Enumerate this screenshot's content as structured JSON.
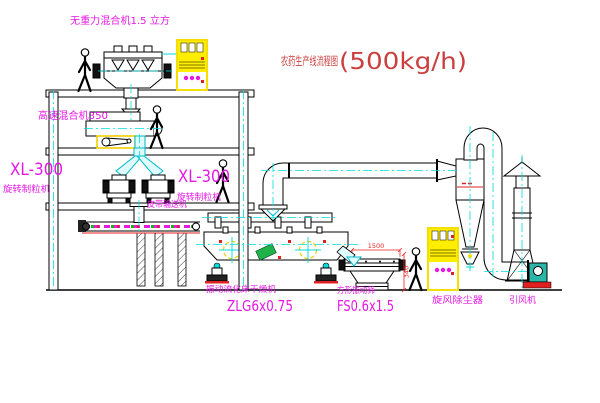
{
  "title": {
    "text_cn": "农药生产线流程图",
    "capacity": "(500kg/h)"
  },
  "labels": {
    "gravity_mixer": "无重力混合机1.5 立方",
    "high_speed_mixer": "高速混合机350",
    "granulator_left_model": "XL-300",
    "granulator_left_name": "旋转制粒机",
    "granulator_right_model": "XL-300",
    "granulator_right_name": "旋转制粒机",
    "belt_conveyor": "皮带输送机",
    "fluid_bed_dryer_name": "振动流化床干燥机",
    "fluid_bed_dryer_model": "ZLG6x0.75",
    "square_sieve_name": "方形振动筛",
    "square_sieve_model": "FS0.6x1.5",
    "cyclone": "旋风除尘器",
    "induced_draft_fan": "引风机"
  },
  "dimensions": {
    "sieve_length": "1500",
    "sieve_height": "340"
  },
  "colors": {
    "label": "#e518e5",
    "title": "#cc3f3f",
    "dim": "#ee2222",
    "centerline": "#00dcdc",
    "cabinet_yellow": "#f5df00",
    "machine_green": "#1fb24a",
    "fan_teal": "#2ab7a9",
    "base_red": "#e02020"
  }
}
